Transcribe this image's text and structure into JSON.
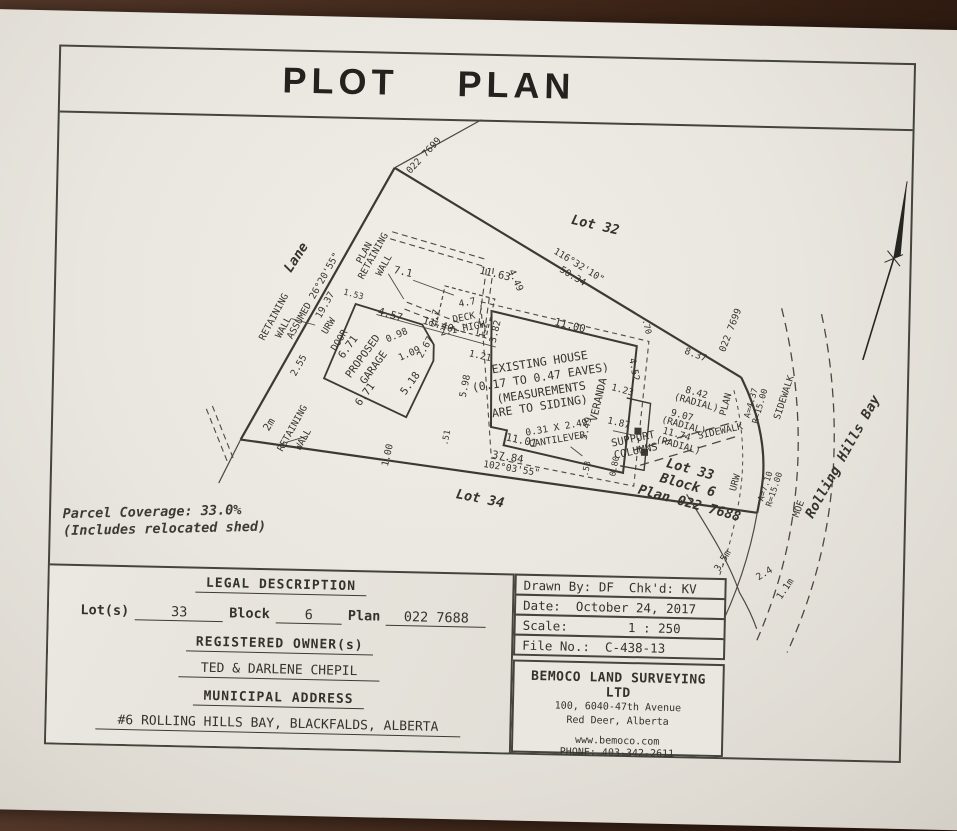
{
  "title": "PLOT    PLAN",
  "note": {
    "line1": "Parcel Coverage: 33.0%",
    "line2": "(Includes relocated shed)"
  },
  "legal": {
    "heading": "LEGAL DESCRIPTION",
    "lot_label": "Lot(s)",
    "lot_value": "33",
    "block_label": "Block",
    "block_value": "6",
    "plan_label": "Plan",
    "plan_value": "022 7688",
    "owner_heading": "REGISTERED OWNER(s)",
    "owner": "TED & DARLENE CHEPIL",
    "address_heading": "MUNICIPAL ADDRESS",
    "address": "#6 ROLLING HILLS BAY, BLACKFALDS, ALBERTA"
  },
  "info": {
    "rows": [
      "Drawn By: DF  Chk'd: KV",
      "Date:  October 24, 2017",
      "Scale:        1 : 250",
      "File No.:  C-438-13"
    ]
  },
  "surveyor": {
    "name": "BEMOCO LAND SURVEYING LTD",
    "address1": "100, 6040-47th Avenue",
    "address2": "Red Deer, Alberta",
    "website": "www.bemoco.com",
    "phone": "PHONE: 403-342-2611"
  },
  "plot": {
    "labels": {
      "lane": "Lane",
      "plan_west": "PLAN",
      "plan_arc": "PLAN",
      "ret_nw": [
        "RETAINING",
        "WALL"
      ],
      "ret_mid": [
        "RETAINING",
        "WALL"
      ],
      "ret_sw": [
        "RETAINING",
        "WALL"
      ],
      "assumed": "ASSUMED 26°20'55\"",
      "d19_37": "19.37",
      "plan7699_top": "022 7699",
      "plan7699_right": "022 7699",
      "lot32": "Lot 32",
      "brgN": "116°32'10\"",
      "d50_34": "50.34",
      "d4_49": "4.49",
      "d7_1": "7.1",
      "d11_63": "11.63",
      "d1_53": "1.53",
      "urw_w": "URW",
      "door": "DOOR",
      "garage": [
        "PROPOSED",
        "GARAGE"
      ],
      "d6_71a": "6.71",
      "d6_71b": "6.71",
      "d4_57": "4.57",
      "d11_40": "11.40",
      "d0_98": "0.98",
      "d1_09": "1.09",
      "d2_67": "2.67",
      "d5_18": "5.18",
      "d2_55": "2.55",
      "d2m": "2m",
      "d1_00": "1.00",
      "deck": [
        "DECK",
        "2.1 HIGH"
      ],
      "d4_7": "4.7",
      "d2_7": "2.7",
      "d3_82": "3.82",
      "d1_2": "1.2",
      "house": [
        "EXISTING HOUSE",
        "(0.17 TO 0.47 EAVES)",
        "(MEASUREMENTS",
        "ARE TO SIDING)"
      ],
      "d11_00": "11.00",
      "d0_70": ".70",
      "d4_52": "4.52",
      "d1_23": "1.23",
      "veranda": "VERANDA",
      "d5_49": "5.49",
      "d1_87": "1.87",
      "support": [
        "SUPPORT",
        "COLUMNS"
      ],
      "cant": [
        "0.31 X 2.49",
        "CANTILEVER"
      ],
      "d11_01": "11.01",
      "d1_21": "1.21",
      "d5_98": "5.98",
      "d0_51": ".51",
      "d0_53": ".53",
      "d0_80": "0.80",
      "d37_84": "37.84",
      "brgS": "102°03'55\"",
      "lot34": "Lot 34",
      "d8_37": "8.37",
      "d8_42": [
        "8.42",
        "(RADIAL)"
      ],
      "d9_07": [
        "9.07",
        "(RADIAL)"
      ],
      "d11_74": [
        "11.74",
        "(RADIAL)"
      ],
      "lot33": [
        "Lot 33",
        "Block 6",
        "Plan 022 7688"
      ],
      "a437": [
        "A=4.37",
        "R=15.00"
      ],
      "a710": [
        "A=7.10",
        "R=15.00"
      ],
      "sidewalk1": "SIDEWALK",
      "sidewalk2": "SIDEWALK",
      "urw_arc": "URW",
      "d3_5m": "3.5m",
      "d2_4": "2.4",
      "d1_1m": "1.1m",
      "moe": "MOE",
      "street": "Rolling Hills Bay"
    }
  }
}
